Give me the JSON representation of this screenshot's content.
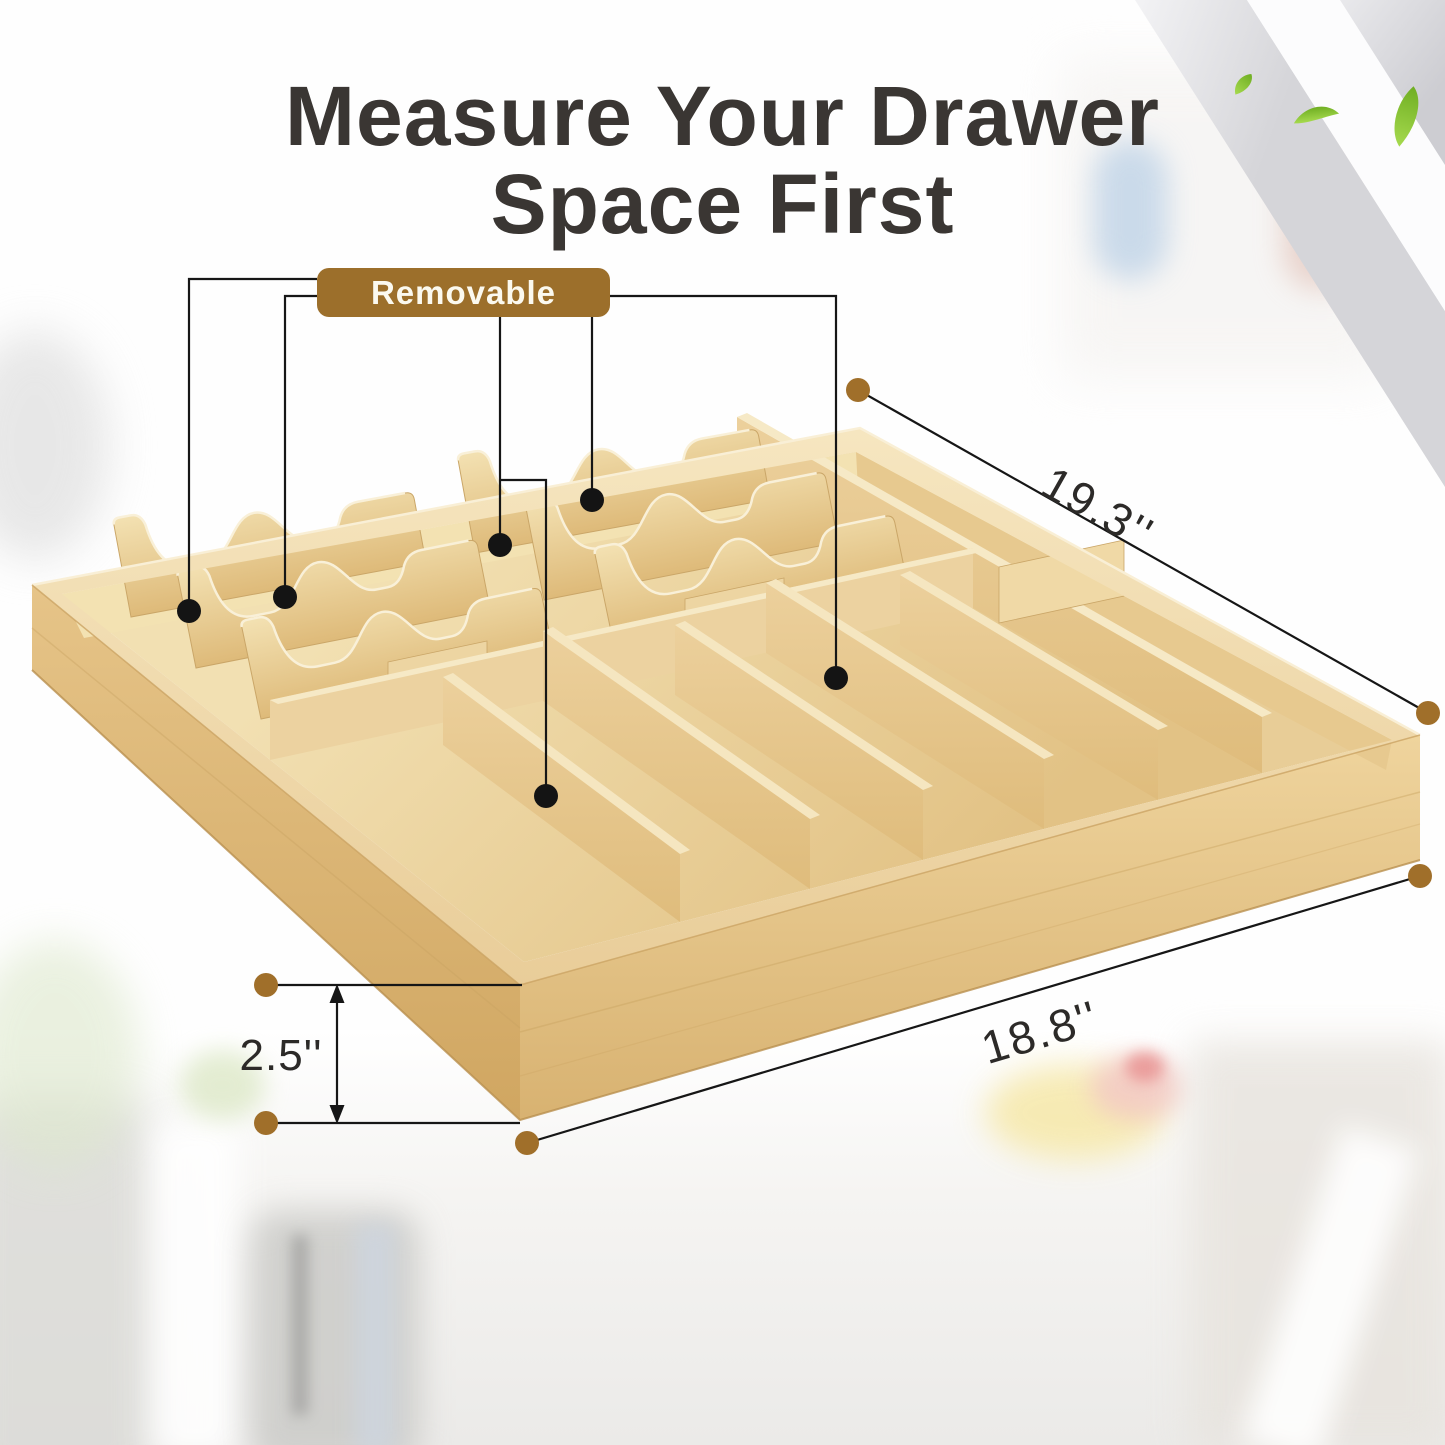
{
  "title": {
    "line1": "Measure Your Drawer",
    "line2": "Space First"
  },
  "badge": {
    "label": "Removable"
  },
  "dimensions": {
    "length_label": "19.3''",
    "width_label": "18.8''",
    "height_label": "2.5''"
  },
  "icons": {
    "leaf": "leaf-icon",
    "callout_dot": "callout-dot",
    "dimension_dot": "dimension-endpoint-dot",
    "double_arrow": "double-arrow-icon"
  },
  "colors": {
    "badge_bg": "#9c6f2b",
    "badge_text": "#fbf9ef",
    "title_text": "#3a3633",
    "annotation_line": "#161616",
    "dimension_dot": "#a06f2a",
    "bamboo_light": "#f2dfae",
    "bamboo_mid": "#e3c286",
    "bamboo_dark": "#d0a661",
    "leaf_green": "#7db832",
    "ribbon_gray": "#d6d6d9"
  }
}
